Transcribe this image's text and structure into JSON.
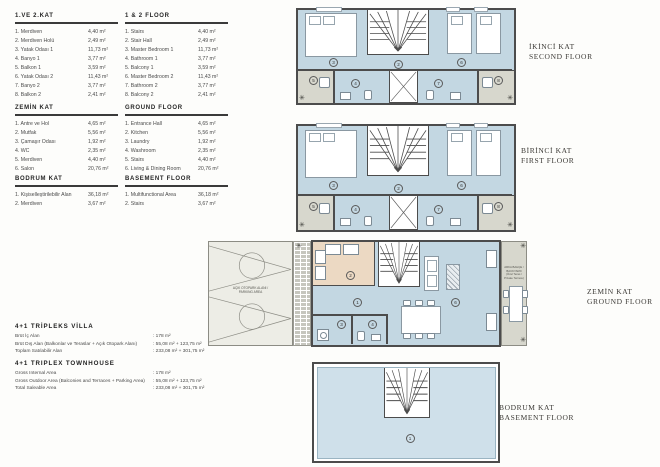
{
  "legends": [
    {
      "title": "1.VE 2.KAT",
      "items": [
        {
          "label": "1. Merdiven",
          "area": "4,40 m²"
        },
        {
          "label": "2. Merdiven Holü",
          "area": "2,49 m²"
        },
        {
          "label": "3. Yatak Odası 1",
          "area": "11,73 m²"
        },
        {
          "label": "4. Banyo 1",
          "area": "3,77 m²"
        },
        {
          "label": "5. Balkon 1",
          "area": "3,59 m²"
        },
        {
          "label": "6. Yatak Odası 2",
          "area": "11,43 m²"
        },
        {
          "label": "7. Banyo 2",
          "area": "3,77 m²"
        },
        {
          "label": "8. Balkon 2",
          "area": "2,41 m²"
        }
      ]
    },
    {
      "title": "1 & 2 FLOOR",
      "items": [
        {
          "label": "1. Stairs",
          "area": "4,40 m²"
        },
        {
          "label": "2. Stair Hall",
          "area": "2,49 m²"
        },
        {
          "label": "3. Master Bedroom 1",
          "area": "11,73 m²"
        },
        {
          "label": "4. Bathroom 1",
          "area": "3,77 m²"
        },
        {
          "label": "5. Balcony 1",
          "area": "3,59 m²"
        },
        {
          "label": "6. Master Bedroom 2",
          "area": "11,43 m²"
        },
        {
          "label": "7. Bathroom 2",
          "area": "3,77 m²"
        },
        {
          "label": "8. Balcony 2",
          "area": "2,41 m²"
        }
      ]
    },
    {
      "title": "ZEMİN KAT",
      "items": [
        {
          "label": "1. Antre ve Hol",
          "area": "4,65 m²"
        },
        {
          "label": "2. Mutfak",
          "area": "5,56 m²"
        },
        {
          "label": "3. Çamaşır Odası",
          "area": "1,92 m²"
        },
        {
          "label": "4. WC",
          "area": "2,35 m²"
        },
        {
          "label": "5. Merdiven",
          "area": "4,40 m²"
        },
        {
          "label": "6. Salon",
          "area": "20,76 m²"
        }
      ]
    },
    {
      "title": "GROUND FLOOR",
      "items": [
        {
          "label": "1. Entrance Hall",
          "area": "4,65 m²"
        },
        {
          "label": "2. Kitchen",
          "area": "5,56 m²"
        },
        {
          "label": "3. Laundry",
          "area": "1,92 m²"
        },
        {
          "label": "4. Washroom",
          "area": "2,35 m²"
        },
        {
          "label": "5. Stairs",
          "area": "4,40 m²"
        },
        {
          "label": "6. Living & Dining Room",
          "area": "20,76 m²"
        }
      ]
    },
    {
      "title": "BODRUM KAT",
      "items": [
        {
          "label": "1. Kişiselleştirilebilir Alan",
          "area": "36,18 m²"
        },
        {
          "label": "2. Merdiven",
          "area": "3,67 m²"
        }
      ]
    },
    {
      "title": "BASEMENT FLOOR",
      "items": [
        {
          "label": "1. Multifunctional Area",
          "area": "36,18 m²"
        },
        {
          "label": "2. Stairs",
          "area": "3,67 m²"
        }
      ]
    }
  ],
  "summary": [
    {
      "title": "4+1 TRİPLEKS VİLLA",
      "rows": [
        {
          "label": "Brüt İç Alan",
          "value": ": 178 m²"
        },
        {
          "label": "Brüt Dış Alan (Balkonlar ve Teraslar + Açık Otopark Alanı)",
          "value": ": 55,08 m² + 123,75 m²"
        },
        {
          "label": "Toplam Satılabilir Alan",
          "value": ": 233,08 m² + 301,75 m²"
        }
      ]
    },
    {
      "title": "4+1 TRIPLEX TOWNHOUSE",
      "rows": [
        {
          "label": "Gross Internal Area",
          "value": ": 178 m²"
        },
        {
          "label": "Gross Outdoor Area (Balconies and Terraces + Parking Area)",
          "value": ": 55,08 m² + 123,75 m²"
        },
        {
          "label": "Total Saleable Area",
          "value": ": 233,08 m² + 301,75 m²"
        }
      ]
    }
  ],
  "floor_labels": {
    "second": {
      "l1": "İKİNCİ KAT",
      "l2": "SECOND FLOOR"
    },
    "first": {
      "l1": "BİRİNCİ KAT",
      "l2": "FIRST FLOOR"
    },
    "ground": {
      "l1": "ZEMİN KAT",
      "l2": "GROUND FLOOR"
    },
    "basement": {
      "l1": "BODRUM KAT",
      "l2": "BASEMENT FLOOR"
    }
  },
  "plan_numbers": {
    "upper": {
      "bedroom1": "3",
      "stairhall": "2",
      "bedroom2": "6",
      "bath1": "4",
      "bath2": "7",
      "balcony1": "5",
      "balcony2": "8"
    },
    "ground": {
      "entrance": "1",
      "kitchen": "2",
      "laundry": "3",
      "washroom": "4",
      "living": "6"
    },
    "basement": {
      "area": "1"
    }
  },
  "annotations": {
    "parking_l1": "AÇIK OTOPARK ALANI /",
    "parking_l2": "PARKING AREA",
    "terrace_l1": "ARKA BAHÇE / BACKYARD",
    "terrace_l2": "(Özel Teras / Private Terrace)"
  },
  "icons": {
    "plant": "✳"
  },
  "colors": {
    "room_blue": "#c3d7e2",
    "basement_blue": "#cfe0ea",
    "terrace_gray": "#d7d7cd",
    "kitchen_tan": "#ecd9c3",
    "wall": "#4c4c4c"
  }
}
